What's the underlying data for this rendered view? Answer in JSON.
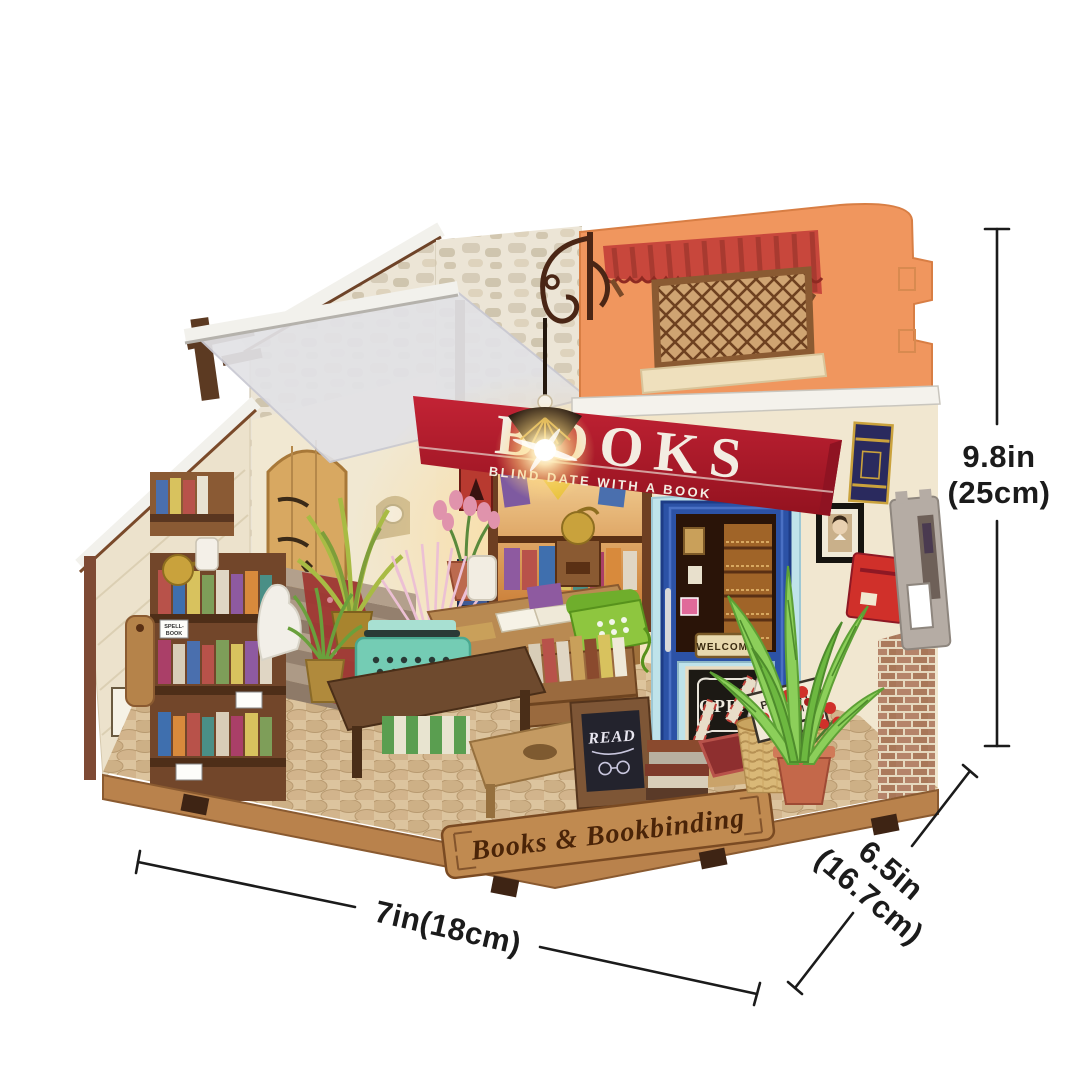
{
  "scene": {
    "background": "#ffffff",
    "model": {
      "signs": {
        "awning_title": "BOOKS",
        "awning_subtitle": "BLIND DATE WITH A BOOK",
        "door_welcome": "WELCOME",
        "door_open": "OPEN",
        "poetry_line1": "POETRY",
        "poetry_line2": "ROOM",
        "chalkboard": "READ",
        "base_plaque": "Books & Bookbinding",
        "shelf_tag_line1": "SPELL-",
        "shelf_tag_line2": "BOOK"
      },
      "colors": {
        "awning_red": "#b61f2f",
        "awning_red_dark": "#8f1322",
        "facade_orange": "#f0965e",
        "tile_roof_red": "#c8473c",
        "door_blue": "#2c52a6",
        "door_trim_blue": "#bfe3ea",
        "wall_cream": "#f1e7d0",
        "stone_grey": "#ece5d6",
        "base_wood": "#b9824c",
        "plaque_wood": "#c08a50",
        "shelf_wood_dark": "#72462a",
        "wicker_tan": "#d9b877",
        "fern_green": "#8ccf5a",
        "flower_red": "#d0302a",
        "tulip_pink": "#e093ac",
        "typewriter_mint": "#74ccb4",
        "lamp_glow": "#ffdf9e",
        "dimension_line": "#1b1b1b"
      }
    },
    "dimensions": {
      "height": {
        "line1": "9.8in",
        "line2": "(25cm)"
      },
      "width": {
        "label": "7in(18cm)"
      },
      "depth": {
        "line1": "6.5in",
        "line2": "(16.7cm)"
      }
    }
  }
}
